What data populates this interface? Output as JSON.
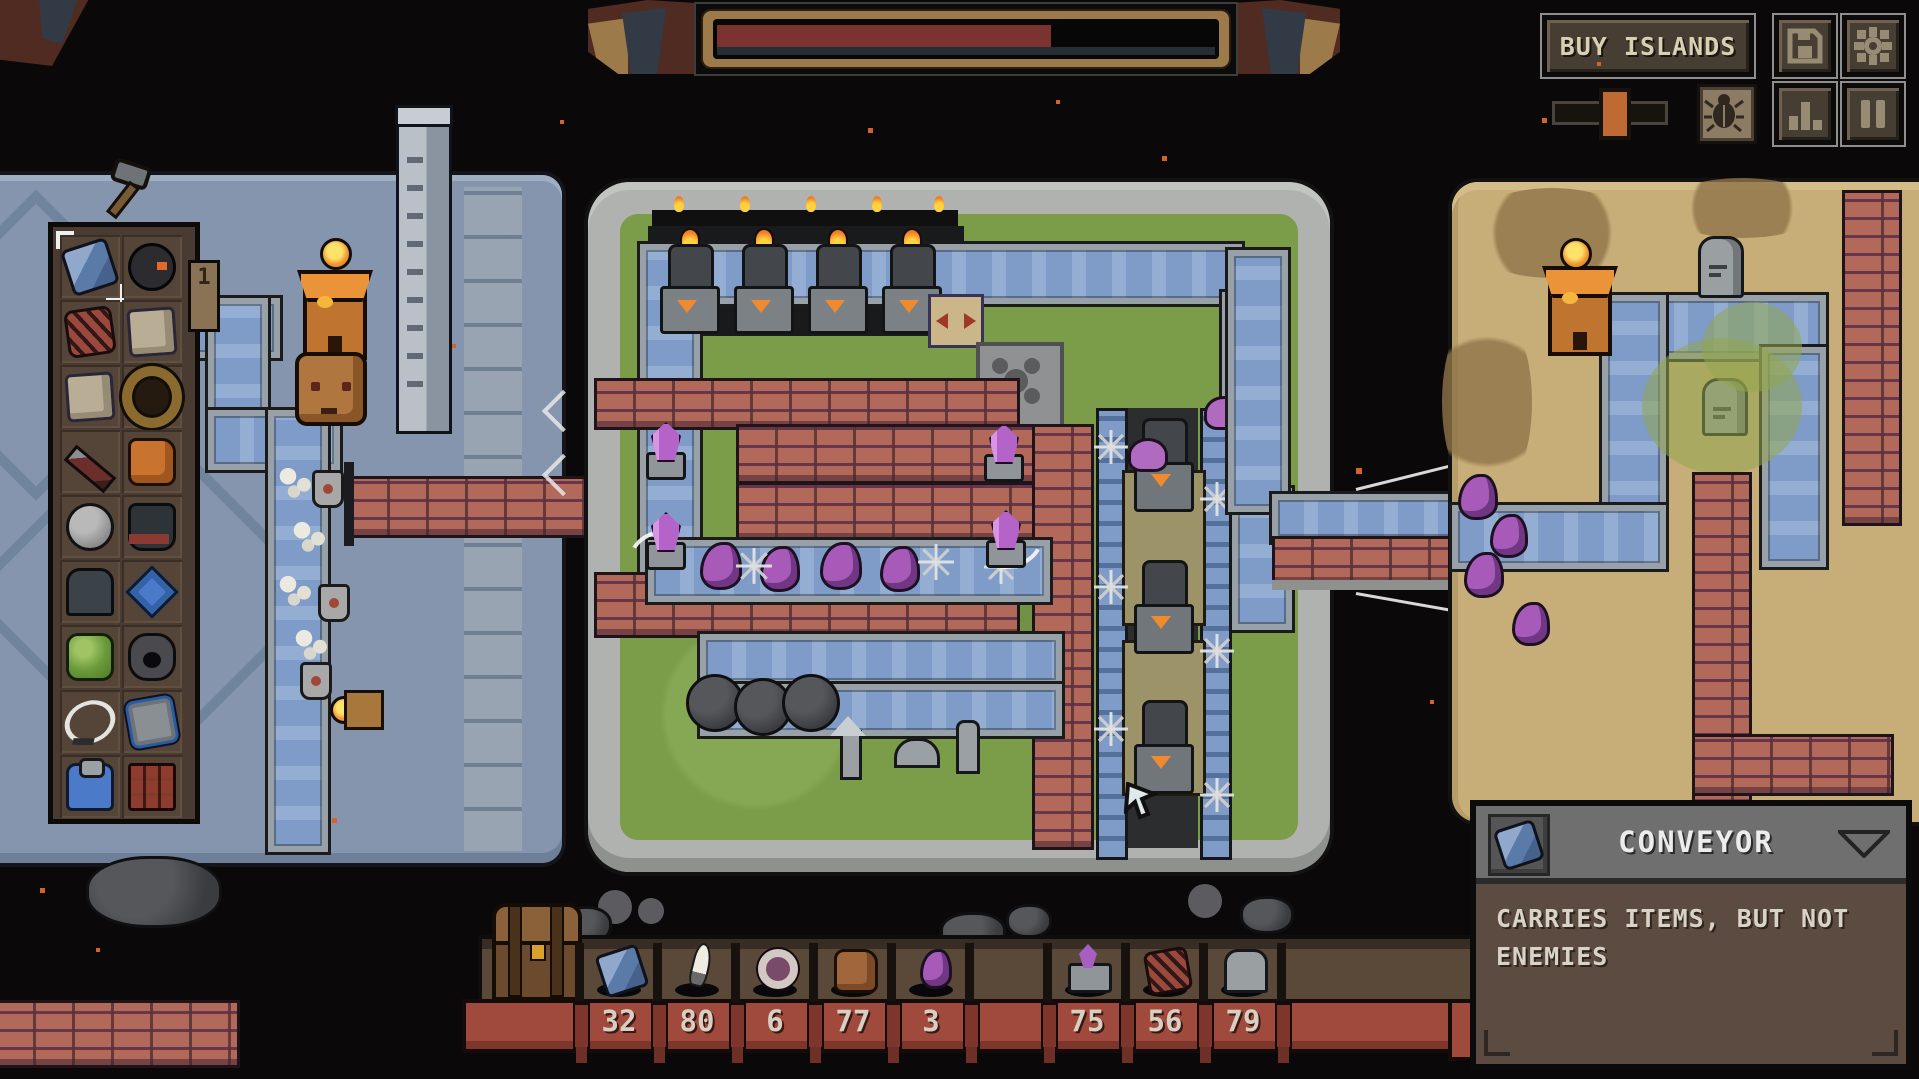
{
  "hud": {
    "progress_bar": {
      "percent": 66,
      "fill_color": "#7b3332",
      "frame_color": "#9c7a4a"
    },
    "buy_islands": {
      "label": "BUY ISLANDS"
    },
    "icons": {
      "save": "save-floppy-icon",
      "settings": "settings-gear-icon",
      "beetle": "beetle-icon",
      "stats": "stats-bars-icon",
      "pause": "pause-icon",
      "slider": "speed-slider"
    }
  },
  "build_panel": {
    "tab_badge": "1",
    "selected_item": "conveyor",
    "items": [
      "conveyor",
      "bomb",
      "copper-coil",
      "stone-block",
      "stone-block-2",
      "wood-ring",
      "spear",
      "orange-claw",
      "boulder",
      "spiked-cauldron",
      "dark-tombstone",
      "blue-rune-charm",
      "slime-pad",
      "burrow-rock",
      "lasso",
      "framed-tile",
      "blue-fountain",
      "rust-crate"
    ]
  },
  "resource_bar": {
    "slots": [
      {
        "icon": "conveyor-icon",
        "count": "32"
      },
      {
        "icon": "blade-icon",
        "count": "80"
      },
      {
        "icon": "ring-icon",
        "count": "6"
      },
      {
        "icon": "critter-icon",
        "count": "77"
      },
      {
        "icon": "tentacle-icon",
        "count": "3"
      },
      {
        "icon": "empty",
        "count": ""
      },
      {
        "icon": "crystal-tower-icon",
        "count": "75"
      },
      {
        "icon": "copper-coil-icon",
        "count": "56"
      },
      {
        "icon": "tombstone-icon",
        "count": "79"
      }
    ]
  },
  "tooltip": {
    "icon": "conveyor-icon",
    "title": "CONVEYOR",
    "body": "CARRIES ITEMS, BUT NOT ENEMIES"
  },
  "world": {
    "islands": [
      "stone-island-left",
      "grass-island-center",
      "desert-island-right"
    ],
    "entities": [
      "furnace-towers",
      "purple-crystal-turrets",
      "tentacle-enemies",
      "skeleton-remains",
      "shield-enemies",
      "watchtowers",
      "tombstones",
      "gas-cloud",
      "cannonballs",
      "rune-pillar",
      "ox-statue",
      "blue-flames",
      "conveyor-bridges"
    ]
  }
}
